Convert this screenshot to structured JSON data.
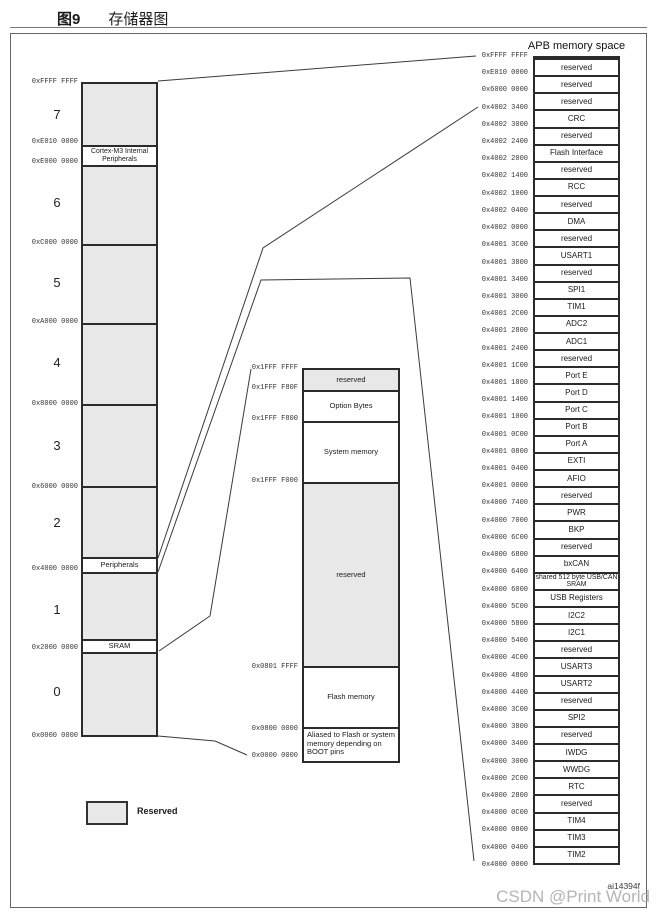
{
  "title": {
    "figure": "图9",
    "caption": "存储器图"
  },
  "legend": {
    "label": "Reserved"
  },
  "watermark": {
    "code": "ai14394f",
    "csdn": "CSDN @Print World"
  },
  "left_column": {
    "region_numbers": [
      "7",
      "6",
      "5",
      "4",
      "3",
      "2",
      "1",
      "0"
    ],
    "addresses": [
      "0xFFFF FFFF",
      "0xE010 0000",
      "0xE000 0000",
      "0xC000 0000",
      "0xA000 0000",
      "0x8000 0000",
      "0x6000 0000",
      "0x4000 0000",
      "0x2000 0000",
      "0x0000 0000"
    ],
    "bands": {
      "cortex": "Cortex-M3 Internal Peripherals",
      "peripherals": "Peripherals",
      "sram": "SRAM"
    }
  },
  "middle_column": {
    "addresses": [
      "0x1FFF FFFF",
      "0x1FFF F80F",
      "0x1FFF F800",
      "0x1FFF F000",
      "0x0801 FFFF",
      "0x0800 0000",
      "0x0000 0000"
    ],
    "segments": [
      "reserved",
      "Option Bytes",
      "System memory",
      "reserved",
      "Flash memory",
      "Aliased to Flash or system memory depending on BOOT pins"
    ]
  },
  "apb": {
    "title": "APB memory space",
    "rows": [
      {
        "label": "reserved",
        "gray": true
      },
      {
        "label": "reserved",
        "gray": true
      },
      {
        "label": "reserved",
        "gray": true
      },
      {
        "label": "CRC"
      },
      {
        "label": "reserved",
        "gray": true
      },
      {
        "label": "Flash Interface"
      },
      {
        "label": "reserved",
        "gray": true
      },
      {
        "label": "RCC"
      },
      {
        "label": "reserved",
        "gray": true
      },
      {
        "label": "DMA"
      },
      {
        "label": "reserved",
        "gray": true
      },
      {
        "label": "USART1"
      },
      {
        "label": "reserved",
        "gray": true
      },
      {
        "label": "SPI1"
      },
      {
        "label": "TIM1"
      },
      {
        "label": "ADC2"
      },
      {
        "label": "ADC1"
      },
      {
        "label": "reserved",
        "gray": true
      },
      {
        "label": "Port E"
      },
      {
        "label": "Port D"
      },
      {
        "label": "Port C"
      },
      {
        "label": "Port B"
      },
      {
        "label": "Port A"
      },
      {
        "label": "EXTI"
      },
      {
        "label": "AFIO"
      },
      {
        "label": "reserved",
        "gray": true
      },
      {
        "label": "PWR"
      },
      {
        "label": "BKP"
      },
      {
        "label": "reserved",
        "gray": true
      },
      {
        "label": "bxCAN"
      },
      {
        "label": "shared 512 byte USB/CAN SRAM",
        "gray": true,
        "small": true
      },
      {
        "label": "USB Registers"
      },
      {
        "label": "I2C2"
      },
      {
        "label": "I2C1"
      },
      {
        "label": "reserved",
        "gray": true
      },
      {
        "label": "USART3"
      },
      {
        "label": "USART2"
      },
      {
        "label": "reserved",
        "gray": true
      },
      {
        "label": "SPI2"
      },
      {
        "label": "reserved",
        "gray": true
      },
      {
        "label": "IWDG"
      },
      {
        "label": "WWDG"
      },
      {
        "label": "RTC"
      },
      {
        "label": "reserved",
        "gray": true
      },
      {
        "label": "TIM4"
      },
      {
        "label": "TIM3"
      },
      {
        "label": "TIM2"
      }
    ],
    "addresses": [
      "0xFFFF FFFF",
      "0xE010 0000",
      "0x6000 0000",
      "0x4002 3400",
      "0x4002 3000",
      "0x4002 2400",
      "0x4002 2000",
      "0x4002 1400",
      "0x4002 1000",
      "0x4002 0400",
      "0x4002 0000",
      "0x4001 3C00",
      "0x4001 3800",
      "0x4001 3400",
      "0x4001 3000",
      "0x4001 2C00",
      "0x4001 2800",
      "0x4001 2400",
      "0x4001 1C00",
      "0x4001 1800",
      "0x4001 1400",
      "0x4001 1000",
      "0x4001 0C00",
      "0x4001 0800",
      "0x4001 0400",
      "0x4001 0000",
      "0x4000 7400",
      "0x4000 7000",
      "0x4000 6C00",
      "0x4000 6800",
      "0x4000 6400",
      "0x4000 6000",
      "0x4000 5C00",
      "0x4000 5800",
      "0x4000 5400",
      "0x4000 4C00",
      "0x4000 4800",
      "0x4000 4400",
      "0x4000 3C00",
      "0x4000 3800",
      "0x4000 3400",
      "0x4000 3000",
      "0x4000 2C00",
      "0x4000 2800",
      "0x4000 0C00",
      "0x4000 0800",
      "0x4000 0400",
      "0x4000 0000"
    ]
  }
}
